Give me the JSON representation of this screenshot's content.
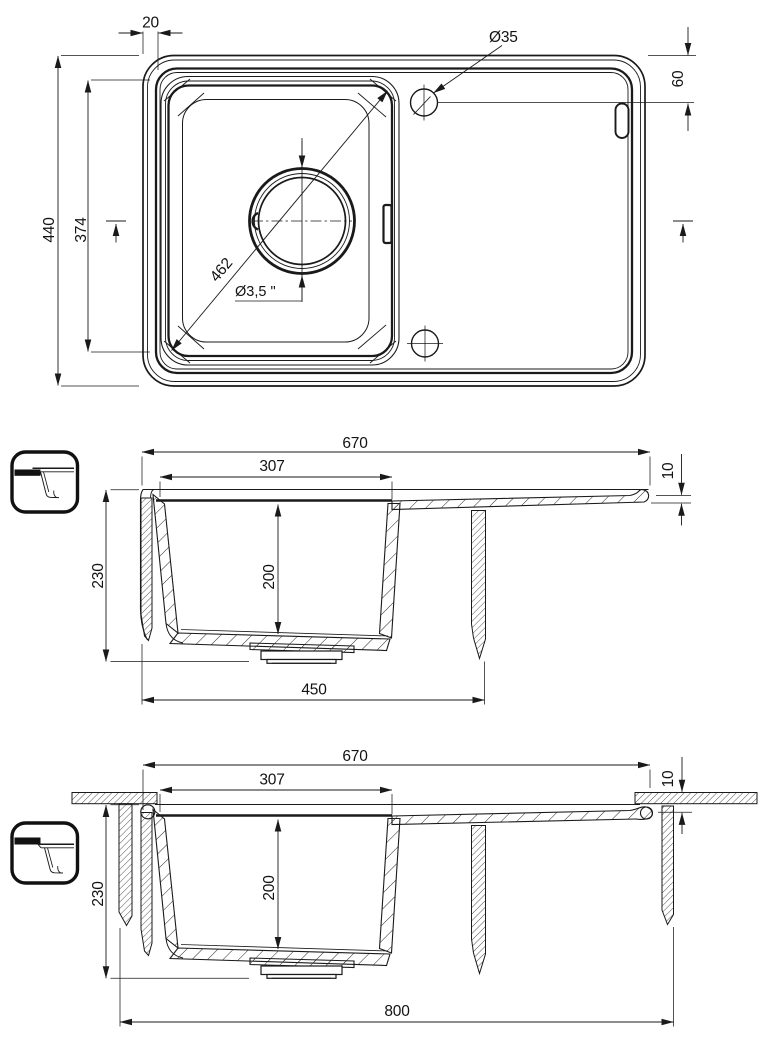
{
  "drawing": {
    "plan": {
      "rim_width": "20",
      "faucet_hole_diameter": "Ø35",
      "hole_edge_distance": "60",
      "overall_width": "440",
      "bowl_width": "374",
      "bowl_diagonal": "462",
      "drain_diameter": "Ø3,5 \""
    },
    "section_inset": {
      "overall_length": "670",
      "bowl_length": "307",
      "overall_height": "230",
      "bowl_depth": "200",
      "bowl_zone_length": "450",
      "rim_thickness": "10"
    },
    "section_flush": {
      "overall_length": "670",
      "bowl_length": "307",
      "overall_height": "230",
      "bowl_depth": "200",
      "min_cabinet_width": "800",
      "recess_depth": "10"
    }
  }
}
